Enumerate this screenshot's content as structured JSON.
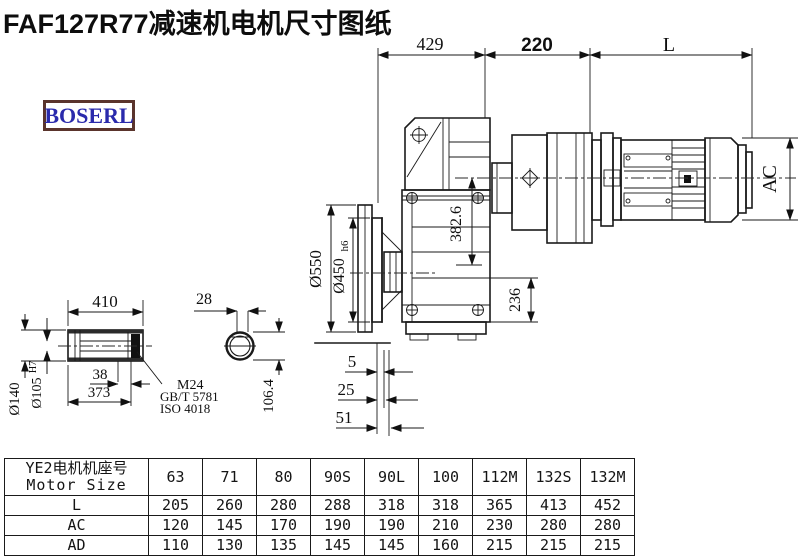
{
  "title": "FAF127R77减速机电机尺寸图纸",
  "logo": "BOSERL",
  "drawing": {
    "dims": {
      "housing_width": "429",
      "adapter_width": "220",
      "motor_length": "L",
      "motor_diameter": "AC",
      "flange_od": "Ø550",
      "flange_spigot": "Ø450",
      "flange_spigot_tol": "h6",
      "axis_height": "382.6",
      "base_height": "236",
      "offset_a": "5",
      "offset_b": "25",
      "offset_c": "51",
      "shaft_length": "410",
      "shaft_step": "38",
      "shaft_body_length": "373",
      "shaft_od": "Ø140",
      "shaft_bore": "Ø105",
      "shaft_bore_tol": "H7",
      "thread": "M24",
      "thread_std_gb": "GB/T 5781",
      "thread_std_iso": "ISO 4018",
      "key_width": "28",
      "key_height": "106.4"
    }
  },
  "table": {
    "header_cn": "YE2电机机座号",
    "header_en": "Motor Size",
    "columns": [
      "63",
      "71",
      "80",
      "90S",
      "90L",
      "100",
      "112M",
      "132S",
      "132M"
    ],
    "rows": [
      {
        "label": "L",
        "values": [
          "205",
          "260",
          "280",
          "288",
          "318",
          "318",
          "365",
          "413",
          "452"
        ]
      },
      {
        "label": "AC",
        "values": [
          "120",
          "145",
          "170",
          "190",
          "190",
          "210",
          "230",
          "280",
          "280"
        ]
      },
      {
        "label": "AD",
        "values": [
          "110",
          "130",
          "135",
          "145",
          "145",
          "160",
          "215",
          "215",
          "215"
        ]
      }
    ]
  }
}
